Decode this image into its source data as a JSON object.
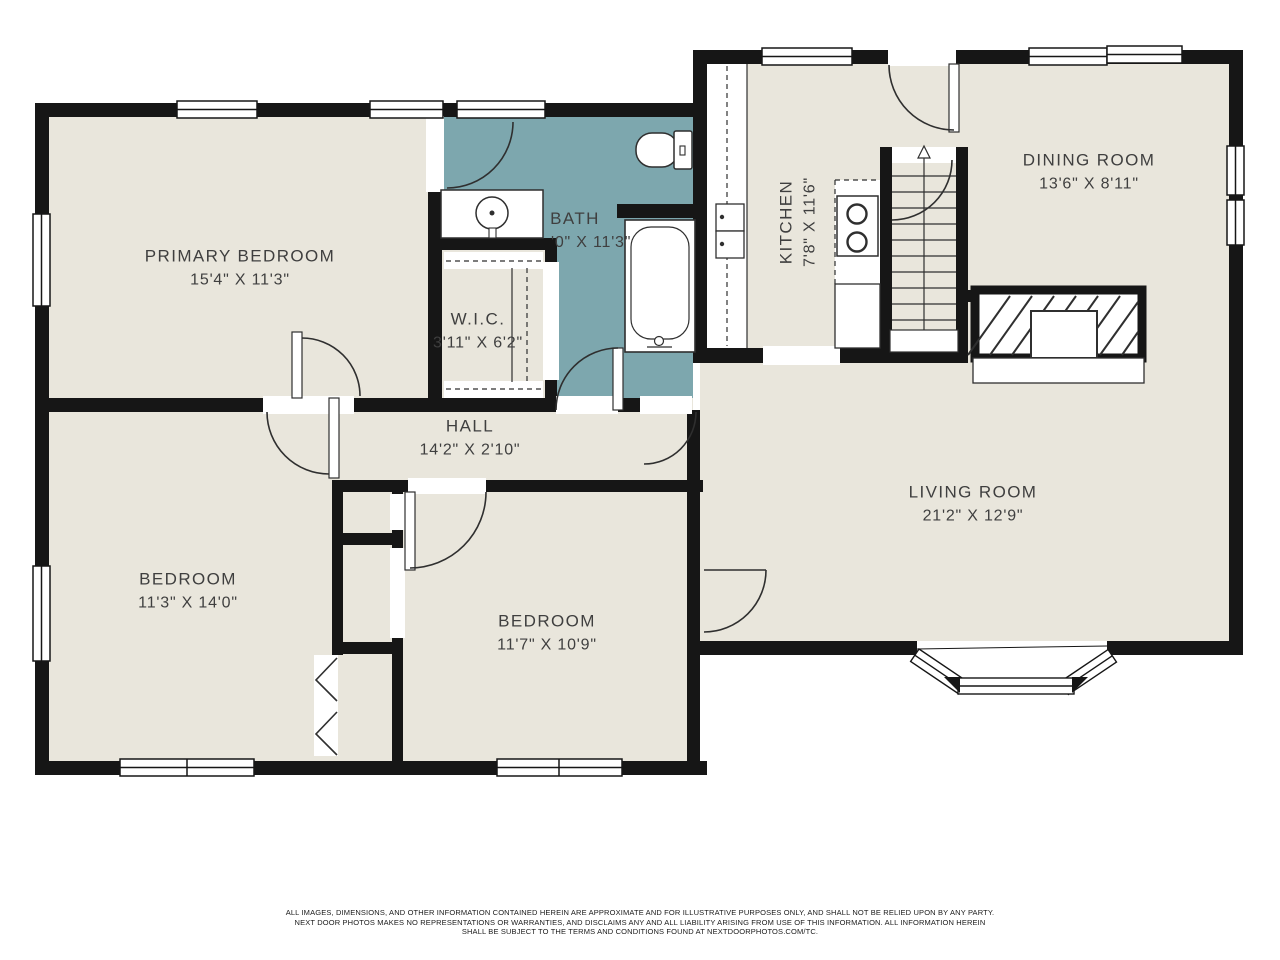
{
  "plan": {
    "colors": {
      "floor": "#e9e6dc",
      "bath_floor": "#7da7ae",
      "wall": "#161616",
      "fixture_line": "#2f2f2f"
    },
    "rooms": [
      {
        "name": "PRIMARY BEDROOM",
        "dims": "15'4\" X 11'3\""
      },
      {
        "name": "BATH",
        "dims": "'0\" X 11'3\""
      },
      {
        "name": "W.I.C.",
        "dims": "3'11\" X 6'2\""
      },
      {
        "name": "HALL",
        "dims": "14'2\" X 2'10\""
      },
      {
        "name": "KITCHEN",
        "dims": "7'8\" X 11'6\""
      },
      {
        "name": "DINING ROOM",
        "dims": "13'6\" X 8'11\""
      },
      {
        "name": "LIVING ROOM",
        "dims": "21'2\" X 12'9\""
      },
      {
        "name": "BEDROOM",
        "dims": "11'3\" X 14'0\""
      },
      {
        "name": "BEDROOM",
        "dims": "11'7\" X 10'9\""
      }
    ],
    "stairs": {
      "direction_icon": "up-arrow"
    },
    "disclaimer": {
      "line1": "ALL IMAGES, DIMENSIONS, AND OTHER INFORMATION CONTAINED HEREIN ARE APPROXIMATE AND FOR ILLUSTRATIVE PURPOSES ONLY, AND SHALL NOT BE RELIED UPON BY ANY PARTY.",
      "line2": "NEXT DOOR PHOTOS MAKES NO REPRESENTATIONS OR WARRANTIES, AND DISCLAIMS ANY AND ALL LIABILITY ARISING FROM USE OF THIS INFORMATION. ALL INFORMATION HEREIN",
      "line3": "SHALL BE SUBJECT TO THE TERMS AND CONDITIONS FOUND AT NEXTDOORPHOTOS.COM/TC."
    }
  }
}
